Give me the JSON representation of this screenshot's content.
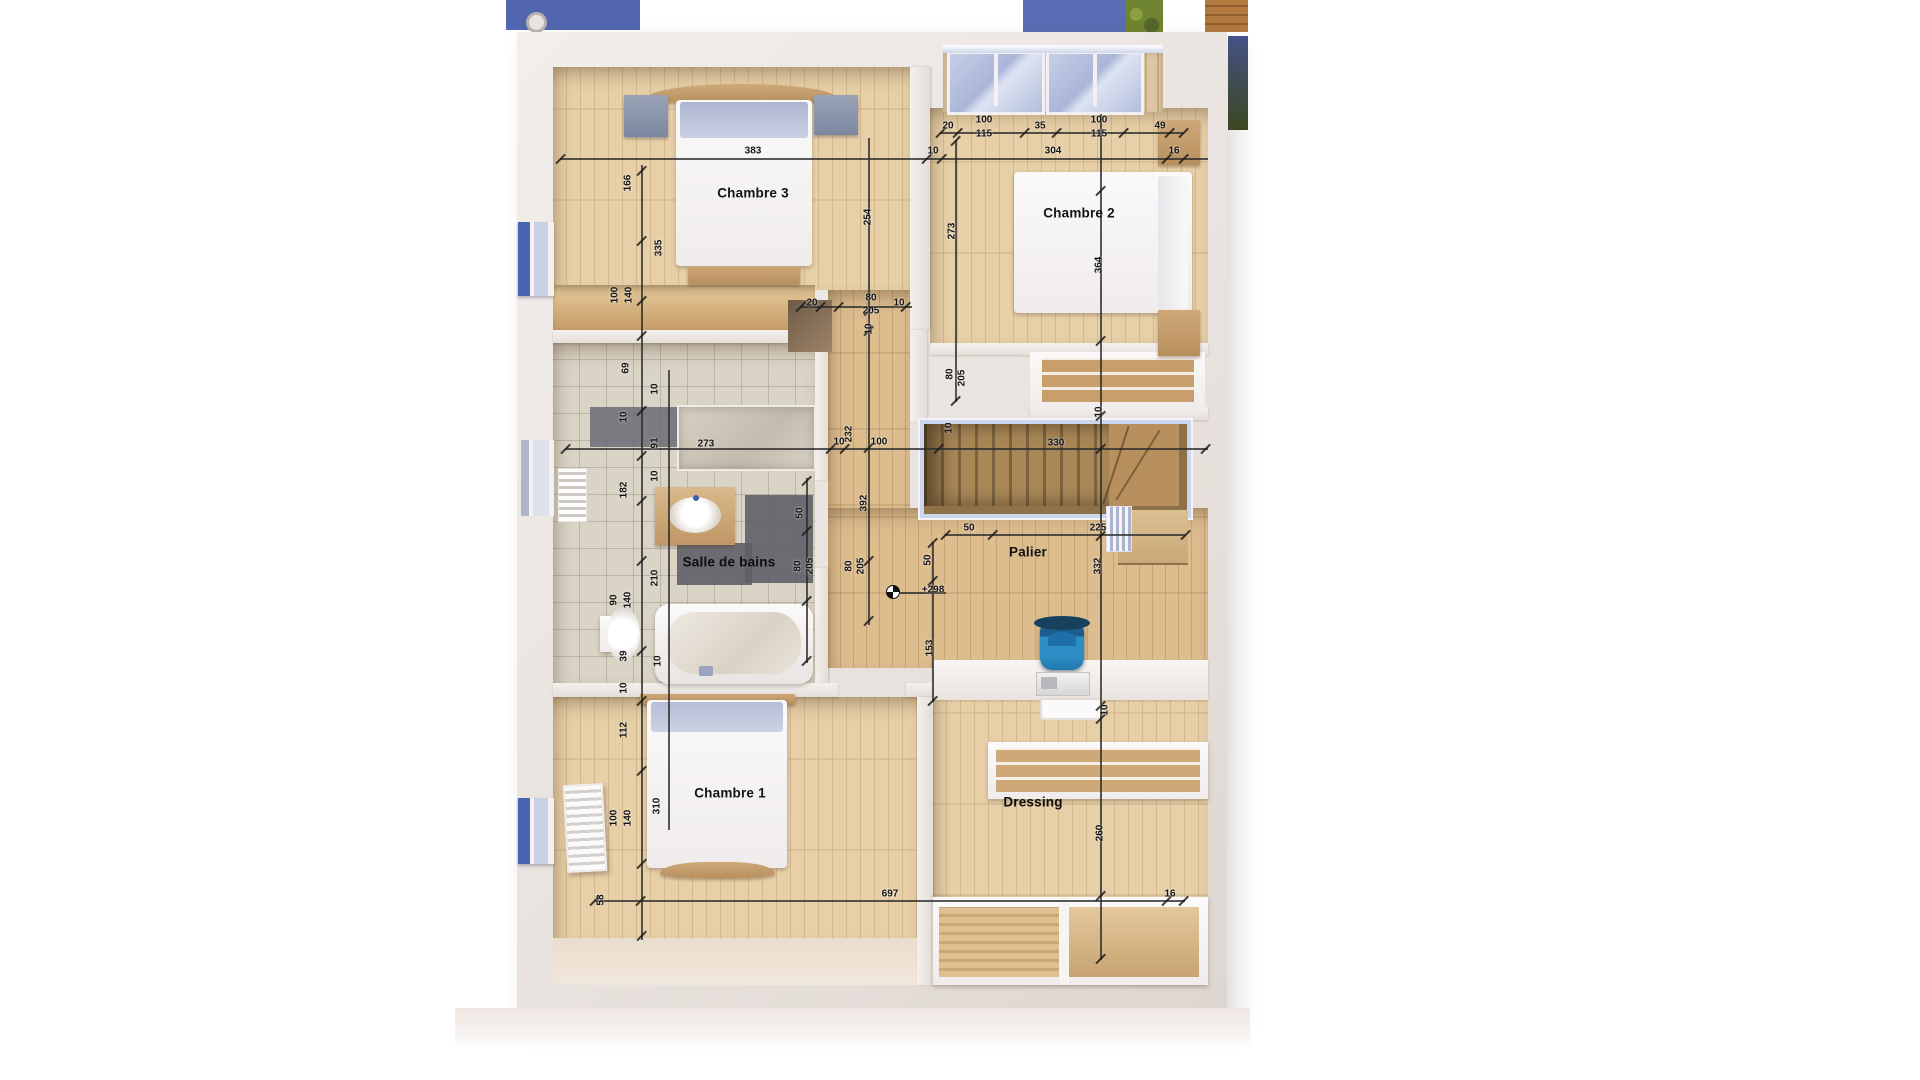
{
  "plan": {
    "type": "floor-plan-render",
    "floor": "étage (upper floor)",
    "level_mark": "+298"
  },
  "rooms": [
    {
      "name": "Chambre 3",
      "x": 753,
      "y": 193
    },
    {
      "name": "Chambre 2",
      "x": 1079,
      "y": 213
    },
    {
      "name": "Salle de bains",
      "x": 729,
      "y": 562
    },
    {
      "name": "Palier",
      "x": 1028,
      "y": 552
    },
    {
      "name": "Chambre 1",
      "x": 730,
      "y": 793
    },
    {
      "name": "Dressing",
      "x": 1033,
      "y": 802
    }
  ],
  "dimensions": [
    {
      "t": "383",
      "x": 753,
      "y": 151,
      "o": "h"
    },
    {
      "t": "10",
      "x": 933,
      "y": 151,
      "o": "h"
    },
    {
      "t": "304",
      "x": 1053,
      "y": 151,
      "o": "h"
    },
    {
      "t": "16",
      "x": 1174,
      "y": 151,
      "o": "h"
    },
    {
      "t": "20",
      "x": 948,
      "y": 126,
      "o": "h"
    },
    {
      "t": "100",
      "x": 984,
      "y": 120,
      "o": "h"
    },
    {
      "t": "115",
      "x": 984,
      "y": 134,
      "o": "h"
    },
    {
      "t": "35",
      "x": 1040,
      "y": 126,
      "o": "h"
    },
    {
      "t": "100",
      "x": 1099,
      "y": 120,
      "o": "h"
    },
    {
      "t": "115",
      "x": 1099,
      "y": 134,
      "o": "h"
    },
    {
      "t": "49",
      "x": 1160,
      "y": 126,
      "o": "h"
    },
    {
      "t": "166",
      "x": 628,
      "y": 183,
      "o": "v"
    },
    {
      "t": "335",
      "x": 659,
      "y": 248,
      "o": "v"
    },
    {
      "t": "100",
      "x": 615,
      "y": 295,
      "o": "v"
    },
    {
      "t": "140",
      "x": 629,
      "y": 295,
      "o": "v"
    },
    {
      "t": "69",
      "x": 626,
      "y": 368,
      "o": "v"
    },
    {
      "t": "10",
      "x": 655,
      "y": 389,
      "o": "v"
    },
    {
      "t": "10",
      "x": 624,
      "y": 417,
      "o": "v"
    },
    {
      "t": "91",
      "x": 655,
      "y": 443,
      "o": "v"
    },
    {
      "t": "10",
      "x": 655,
      "y": 476,
      "o": "v"
    },
    {
      "t": "182",
      "x": 624,
      "y": 490,
      "o": "v"
    },
    {
      "t": "210",
      "x": 655,
      "y": 578,
      "o": "v"
    },
    {
      "t": "90",
      "x": 614,
      "y": 600,
      "o": "v"
    },
    {
      "t": "140",
      "x": 628,
      "y": 600,
      "o": "v"
    },
    {
      "t": "39",
      "x": 624,
      "y": 656,
      "o": "v"
    },
    {
      "t": "10",
      "x": 658,
      "y": 661,
      "o": "v"
    },
    {
      "t": "10",
      "x": 624,
      "y": 688,
      "o": "v"
    },
    {
      "t": "112",
      "x": 624,
      "y": 730,
      "o": "v"
    },
    {
      "t": "310",
      "x": 657,
      "y": 806,
      "o": "v"
    },
    {
      "t": "100",
      "x": 614,
      "y": 818,
      "o": "v"
    },
    {
      "t": "140",
      "x": 628,
      "y": 818,
      "o": "v"
    },
    {
      "t": "58",
      "x": 601,
      "y": 900,
      "o": "v"
    },
    {
      "t": "254",
      "x": 868,
      "y": 217,
      "o": "v"
    },
    {
      "t": "273",
      "x": 952,
      "y": 231,
      "o": "v"
    },
    {
      "t": "364",
      "x": 1099,
      "y": 265,
      "o": "v"
    },
    {
      "t": "20",
      "x": 812,
      "y": 303,
      "o": "h"
    },
    {
      "t": "80",
      "x": 871,
      "y": 298,
      "o": "h"
    },
    {
      "t": "205",
      "x": 871,
      "y": 311,
      "o": "h"
    },
    {
      "t": "10",
      "x": 899,
      "y": 303,
      "o": "h"
    },
    {
      "t": "10",
      "x": 869,
      "y": 329,
      "o": "v"
    },
    {
      "t": "80",
      "x": 950,
      "y": 374,
      "o": "v"
    },
    {
      "t": "205",
      "x": 962,
      "y": 378,
      "o": "v"
    },
    {
      "t": "10",
      "x": 949,
      "y": 428,
      "o": "v"
    },
    {
      "t": "232",
      "x": 849,
      "y": 434,
      "o": "v"
    },
    {
      "t": "10",
      "x": 839,
      "y": 442,
      "o": "h"
    },
    {
      "t": "100",
      "x": 879,
      "y": 442,
      "o": "h"
    },
    {
      "t": "273",
      "x": 706,
      "y": 444,
      "o": "h"
    },
    {
      "t": "330",
      "x": 1056,
      "y": 443,
      "o": "h"
    },
    {
      "t": "10",
      "x": 1099,
      "y": 412,
      "o": "v"
    },
    {
      "t": "392",
      "x": 864,
      "y": 503,
      "o": "v"
    },
    {
      "t": "50",
      "x": 800,
      "y": 513,
      "o": "v"
    },
    {
      "t": "80",
      "x": 798,
      "y": 566,
      "o": "v"
    },
    {
      "t": "205",
      "x": 810,
      "y": 566,
      "o": "v"
    },
    {
      "t": "80",
      "x": 849,
      "y": 566,
      "o": "v"
    },
    {
      "t": "205",
      "x": 861,
      "y": 566,
      "o": "v"
    },
    {
      "t": "50",
      "x": 969,
      "y": 528,
      "o": "h"
    },
    {
      "t": "225",
      "x": 1098,
      "y": 528,
      "o": "h"
    },
    {
      "t": "50",
      "x": 928,
      "y": 560,
      "o": "v"
    },
    {
      "t": "153",
      "x": 930,
      "y": 648,
      "o": "v"
    },
    {
      "t": "332",
      "x": 1098,
      "y": 566,
      "o": "v"
    },
    {
      "t": "+298",
      "x": 933,
      "y": 590,
      "o": "h"
    },
    {
      "t": "10",
      "x": 1105,
      "y": 710,
      "o": "v"
    },
    {
      "t": "260",
      "x": 1100,
      "y": 833,
      "o": "v"
    },
    {
      "t": "697",
      "x": 890,
      "y": 894,
      "o": "h"
    },
    {
      "t": "16",
      "x": 1170,
      "y": 894,
      "o": "h"
    }
  ],
  "colors": {
    "accent_blue": "#5166ae",
    "railing_blue": "#ccd6ee",
    "bag_blue": "#2d8ec6",
    "wood_light": "#e7d0a7",
    "wood_mid": "#ddbd8e",
    "tile_beige": "#dad4c6",
    "rug_gray": "#61616b",
    "greenery": "#6f8430"
  }
}
